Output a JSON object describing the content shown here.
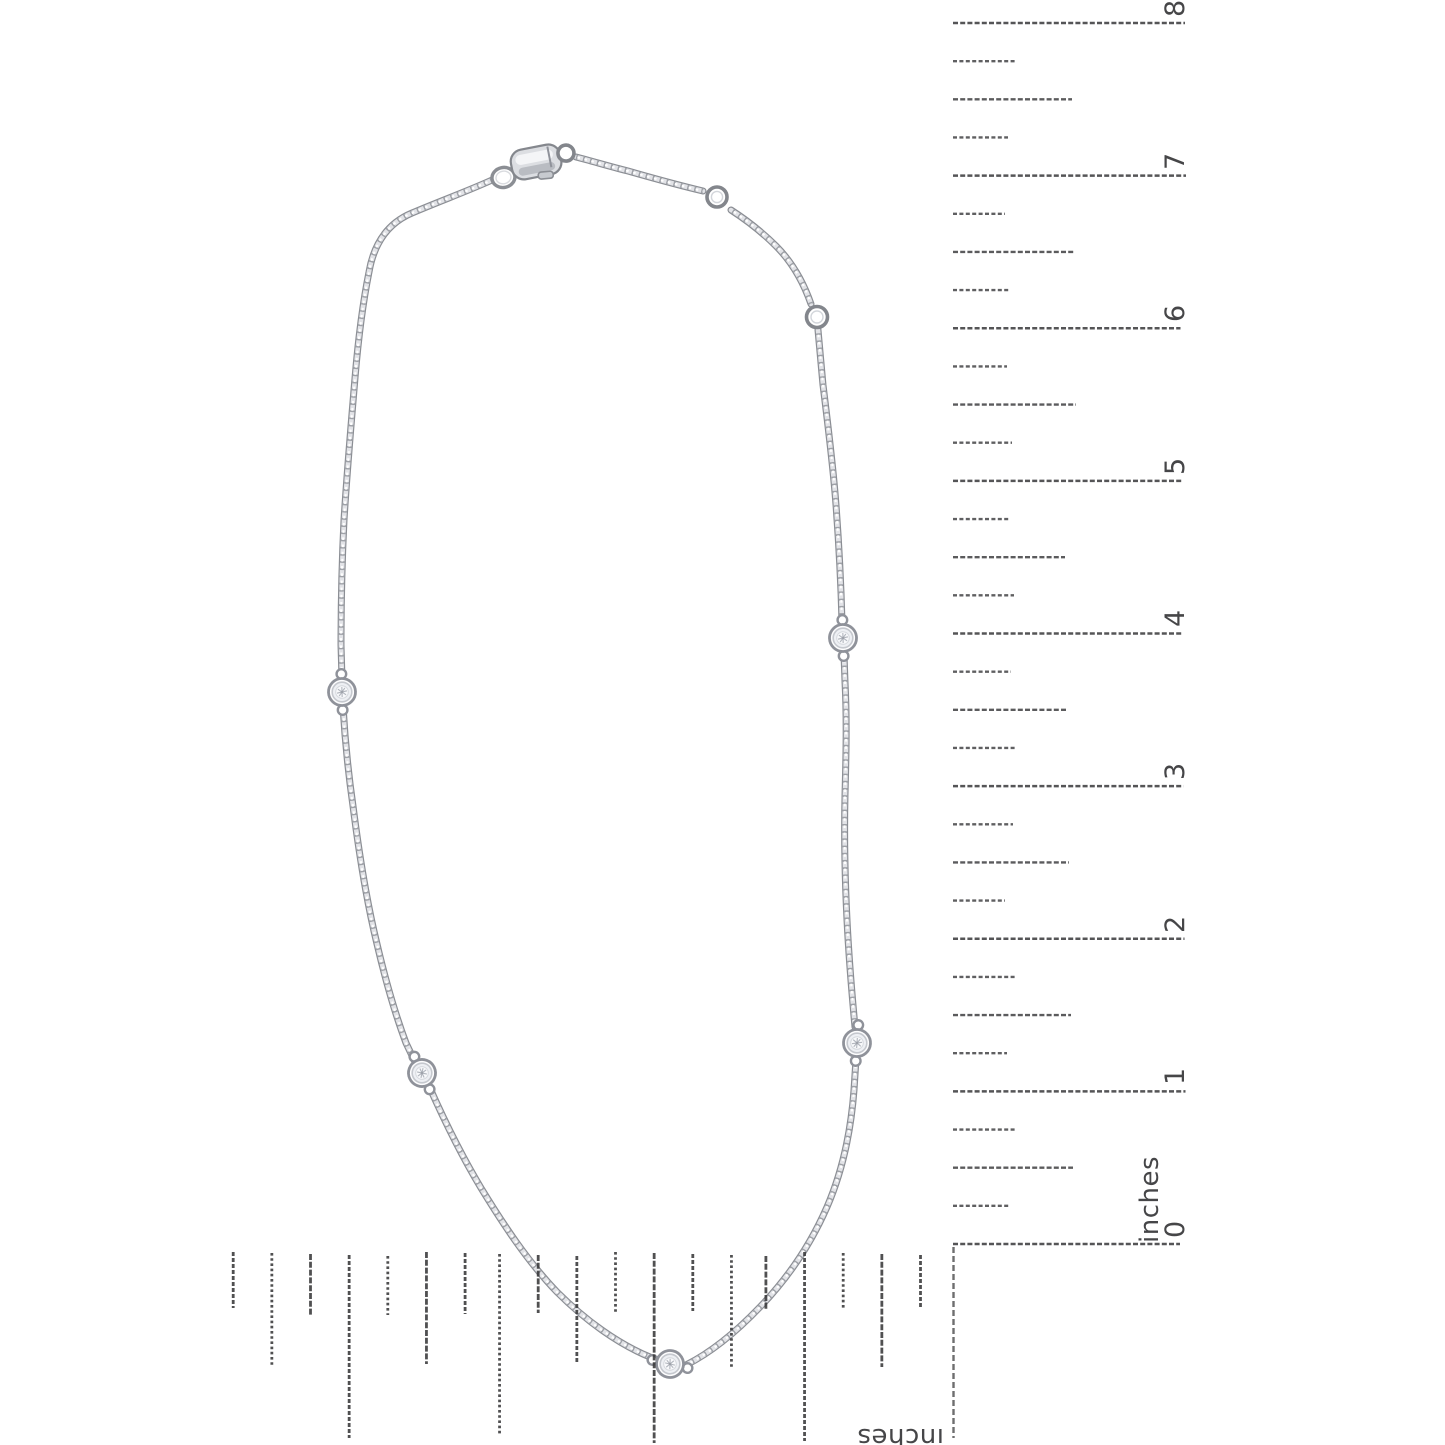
{
  "ruler_right": {
    "unit_label": "inches",
    "labels": [
      "0",
      "1",
      "2",
      "3",
      "4",
      "5",
      "6",
      "7",
      "8"
    ]
  },
  "ruler_bottom": {
    "unit_label": "inches"
  },
  "necklace": {
    "station_count": 5,
    "jump_ring_count": 3
  },
  "colors": {
    "background": "#ffffff",
    "metal_dark": "#8b8e94",
    "metal_light": "#e2e3e7",
    "metal_mid": "#a8abb1",
    "ruler_mark": "#38383a"
  }
}
